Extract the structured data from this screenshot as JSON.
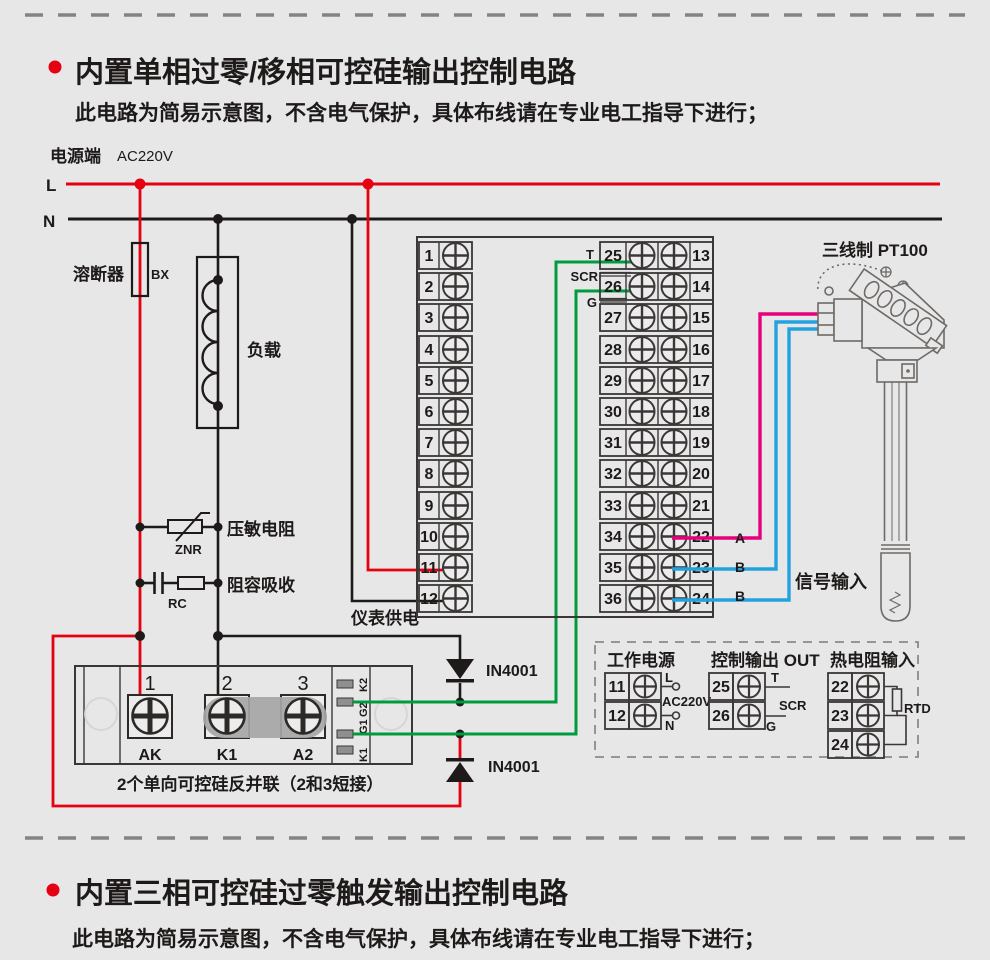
{
  "section1": {
    "title": "内置单相过零/移相可控硅输出控制电路",
    "subtitle": "此电路为简易示意图，不含电气保护，具体布线请在专业电工指导下进行；"
  },
  "section2": {
    "title": "内置三相可控硅过零触发输出控制电路",
    "subtitle": "此电路为简易示意图，不含电气保护，具体布线请在专业电工指导下进行；"
  },
  "power": {
    "terminal_label": "电源端",
    "voltage": "AC220V",
    "l": "L",
    "n": "N"
  },
  "parts": {
    "fuse": "溶断器",
    "fuse_code": "BX",
    "load": "负载",
    "varistor": "压敏电阻",
    "varistor_code": "ZNR",
    "rc": "阻容吸收",
    "rc_code": "RC",
    "meter_supply": "仪表供电",
    "diode1": "IN4001",
    "diode2": "IN4001",
    "module_note": "2个单向可控硅反并联（2和3短接）"
  },
  "module": {
    "top": [
      "1",
      "2",
      "3"
    ],
    "bottom": [
      "AK",
      "K1",
      "A2"
    ],
    "side": [
      "K2",
      "G2",
      "G1",
      "K1"
    ]
  },
  "block": {
    "left": [
      "1",
      "2",
      "3",
      "4",
      "5",
      "6",
      "7",
      "8",
      "9",
      "10",
      "11",
      "12"
    ],
    "mid": [
      "25",
      "26",
      "27",
      "28",
      "29",
      "30",
      "31",
      "32",
      "33",
      "34",
      "35",
      "36"
    ],
    "right": [
      "13",
      "14",
      "15",
      "16",
      "17",
      "18",
      "19",
      "20",
      "21",
      "22",
      "23",
      "24"
    ],
    "t": "T",
    "scr": "SCR",
    "g": "G"
  },
  "sensor": {
    "type": "三线制 PT100",
    "a": "A",
    "b1": "B",
    "b2": "B",
    "signal": "信号输入"
  },
  "legend": {
    "power": {
      "title": "工作电源",
      "n1": "11",
      "n2": "12",
      "l": "L",
      "v": "AC220V",
      "n": "N"
    },
    "out": {
      "title": "控制输出 OUT",
      "n1": "25",
      "n2": "26",
      "t": "T",
      "scr": "SCR",
      "g": "G"
    },
    "rtd": {
      "title": "热电阻输入",
      "n1": "22",
      "n2": "23",
      "n3": "24",
      "label": "RTD"
    }
  },
  "colors": {
    "red": "#e50012",
    "green": "#009b3f",
    "magenta": "#e6007d",
    "blue": "#22a3df"
  }
}
